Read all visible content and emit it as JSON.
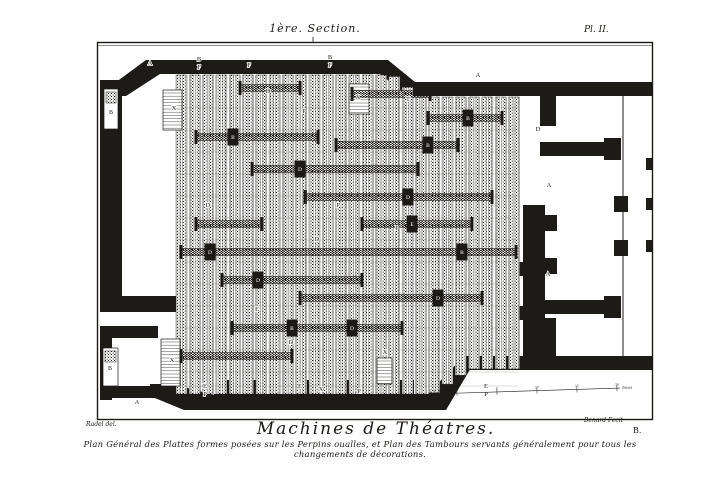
{
  "plate": {
    "section_label": "1ère. Section.",
    "plate_number": "Pl. II.",
    "title": "Machines de Théatres.",
    "caption": "Plan Général des Plattes formes posées sur les Perpins oualles, et Plan des Tambours servants généralement pour tous les changements de décorations.",
    "credit_left": "Radel del.",
    "credit_right": "Benard Fecit",
    "corner_mark": "B.",
    "ink_color": "#1c1b18",
    "paper_color": "#ffffff"
  },
  "plan": {
    "stairs_label": "X",
    "niche_labels": [
      {
        "t": "B",
        "x": 111,
        "y": 114
      },
      {
        "t": "B",
        "x": 110,
        "y": 370
      }
    ],
    "wall_labels": [
      {
        "t": "A",
        "x": 150,
        "y": 65
      },
      {
        "t": "A",
        "x": 478,
        "y": 77
      },
      {
        "t": "A",
        "x": 549,
        "y": 187
      },
      {
        "t": "A",
        "x": 548,
        "y": 276
      },
      {
        "t": "A",
        "x": 137,
        "y": 404
      },
      {
        "t": "X",
        "x": 174,
        "y": 110
      },
      {
        "t": "X",
        "x": 358,
        "y": 99
      },
      {
        "t": "X",
        "x": 172,
        "y": 362
      },
      {
        "t": "X",
        "x": 385,
        "y": 354
      },
      {
        "t": "B",
        "x": 199,
        "y": 61
      },
      {
        "t": "F",
        "x": 199,
        "y": 69
      },
      {
        "t": "F",
        "x": 249,
        "y": 67
      },
      {
        "t": "B",
        "x": 330,
        "y": 59
      },
      {
        "t": "F",
        "x": 330,
        "y": 67
      },
      {
        "t": "D",
        "x": 268,
        "y": 93
      },
      {
        "t": "P",
        "x": 304,
        "y": 113
      },
      {
        "t": "T",
        "x": 408,
        "y": 101
      },
      {
        "t": "D",
        "x": 538,
        "y": 131
      },
      {
        "t": "D",
        "x": 208,
        "y": 207
      },
      {
        "t": "P",
        "x": 338,
        "y": 207
      },
      {
        "t": "D",
        "x": 317,
        "y": 241
      },
      {
        "t": "P",
        "x": 397,
        "y": 230
      },
      {
        "t": "E",
        "x": 257,
        "y": 311
      },
      {
        "t": "D",
        "x": 291,
        "y": 344
      },
      {
        "t": "E",
        "x": 205,
        "y": 388
      },
      {
        "t": "P",
        "x": 205,
        "y": 396
      },
      {
        "t": "E",
        "x": 300,
        "y": 388
      },
      {
        "t": "X",
        "x": 321,
        "y": 391
      },
      {
        "t": "P",
        "x": 359,
        "y": 393
      },
      {
        "t": "E",
        "x": 486,
        "y": 388
      },
      {
        "t": "P",
        "x": 486,
        "y": 396
      }
    ],
    "drum_blocks": [
      {
        "t": "B",
        "x": 233,
        "y": 137
      },
      {
        "t": "B",
        "x": 428,
        "y": 145
      },
      {
        "t": "D",
        "x": 300,
        "y": 169
      },
      {
        "t": "D",
        "x": 408,
        "y": 197
      },
      {
        "t": "B",
        "x": 468,
        "y": 118
      },
      {
        "t": "D",
        "x": 210,
        "y": 252
      },
      {
        "t": "B",
        "x": 462,
        "y": 252
      },
      {
        "t": "E",
        "x": 412,
        "y": 224
      },
      {
        "t": "D",
        "x": 258,
        "y": 280
      },
      {
        "t": "D",
        "x": 438,
        "y": 298
      },
      {
        "t": "B",
        "x": 292,
        "y": 328
      },
      {
        "t": "D",
        "x": 352,
        "y": 328
      }
    ],
    "scale_bar": {
      "minor_numbers": [
        "5",
        "4",
        "3",
        "2",
        "1"
      ],
      "zero_label": "0",
      "major_labels": [
        "5",
        "10",
        "15",
        "20"
      ],
      "unit_label": "Toises"
    }
  }
}
